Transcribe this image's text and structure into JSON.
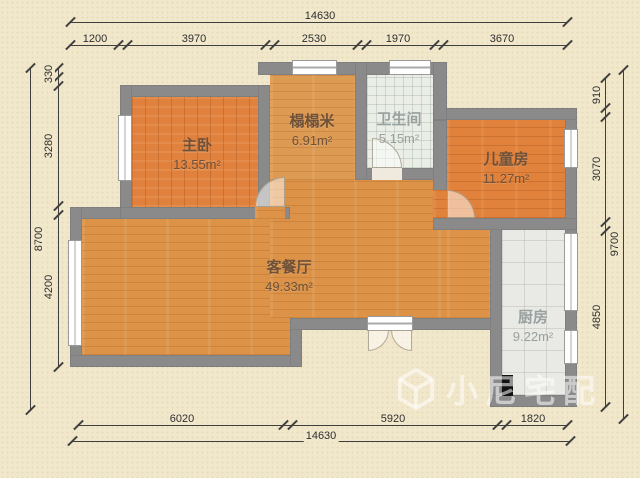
{
  "watermark": {
    "text": "小尼宅配"
  },
  "rooms": [
    {
      "name": "主卧",
      "area_label": "13.55m²"
    },
    {
      "name": "榻榻米",
      "area_label": "6.91m²"
    },
    {
      "name": "卫生间",
      "area_label": "5.15m²"
    },
    {
      "name": "儿童房",
      "area_label": "11.27m²"
    },
    {
      "name": "客餐厅",
      "area_label": "49.33m²"
    },
    {
      "name": "厨房",
      "area_label": "9.22m²"
    }
  ],
  "dimensions": {
    "top_total": "14630",
    "top_segments": [
      "1200",
      "3970",
      "2530",
      "1970",
      "3670"
    ],
    "bottom_total": "14630",
    "bottom_segments": [
      "6020",
      "5920",
      "1820"
    ],
    "left_total": "8700",
    "left_segments": [
      "330",
      "3280",
      "4200"
    ],
    "right_total": "9700",
    "right_segments": [
      "910",
      "3070",
      "4850"
    ]
  },
  "colors": {
    "background": "#f1e7cb",
    "wall": "#8a8a8a",
    "wood_warm": "#e0813d",
    "wood_light": "#dc9348",
    "tile_bath": "#eaeee6",
    "tile_kitchen": "#e9e9e5",
    "dim_line": "#3f3f3f",
    "watermark_text": "rgba(255,255,255,0.55)"
  }
}
